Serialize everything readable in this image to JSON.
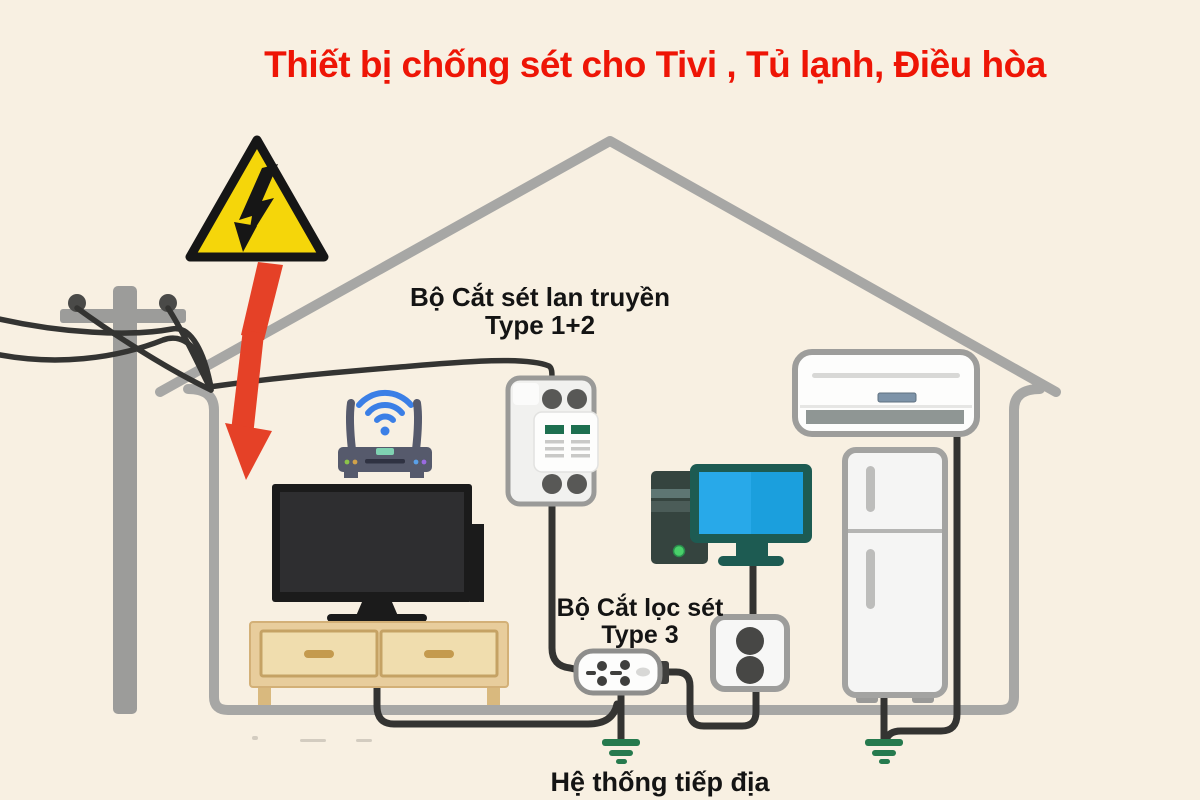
{
  "title": "Thiết bị chống sét cho Tivi , Tủ lạnh, Điều hòa",
  "labels": {
    "type12_line1": "Bộ Cắt sét lan truyền",
    "type12_line2": "Type 1+2",
    "type3_line1": "Bộ Cắt lọc sét",
    "type3_line2": "Type 3",
    "grounding": "Hệ thống tiếp địa"
  },
  "icons": {
    "warning": "high-voltage-warning-triangle-icon",
    "lightning": "red-lightning-strike-arrow-icon",
    "wifi": "wifi-signal-icon",
    "ground": "earth-ground-symbol-icon"
  },
  "scene_devices": [
    "power-pole",
    "surge-protector-type-1+2",
    "wifi-router",
    "tv",
    "tv-cabinet",
    "desktop-computer",
    "air-conditioner",
    "refrigerator",
    "power-strip-type-3",
    "wall-outlet",
    "grounding-system"
  ],
  "colors": {
    "background": "#f8f0e2",
    "title_red": "#ee1506",
    "lightning_red": "#e54127",
    "warning_yellow": "#f5d60a",
    "house_gray": "#a7a7a5",
    "wire_black": "#343432",
    "ground_green": "#267a4e",
    "wifi_blue": "#3b7fe6",
    "screen_blue": "#28a9e9",
    "cabinet_wood": "#e8cd9c",
    "label_black": "#141414"
  }
}
